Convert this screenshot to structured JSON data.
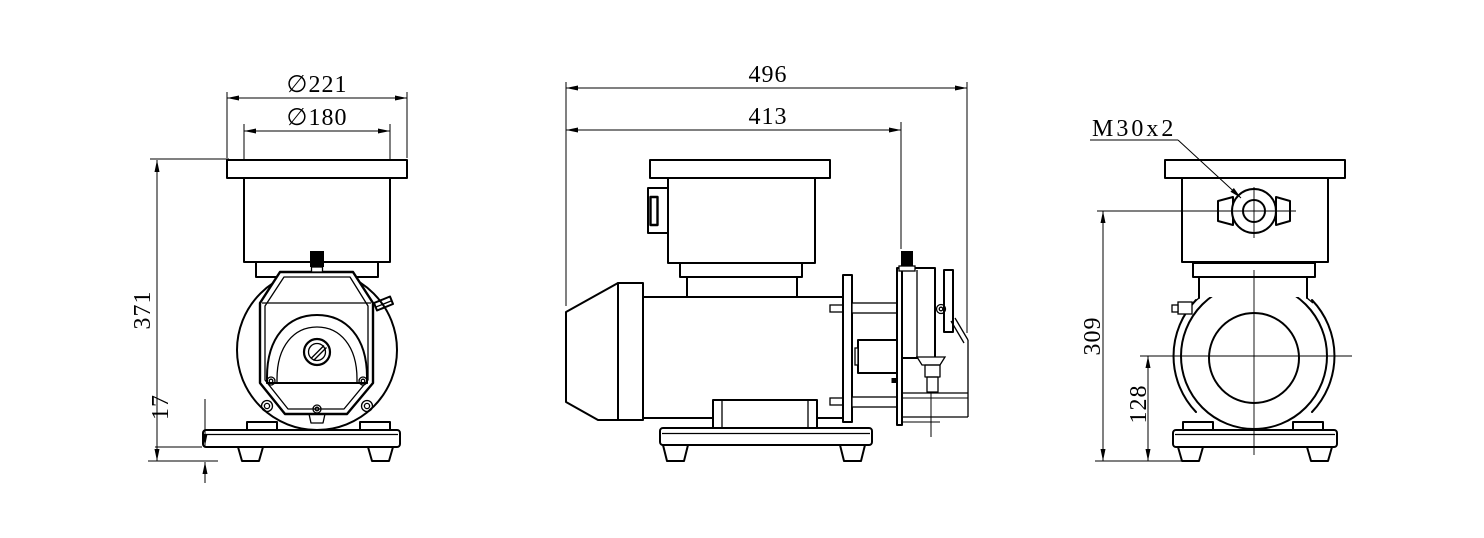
{
  "drawing": {
    "background": "#ffffff",
    "line_color": "#000000",
    "views": {
      "front": {
        "dims": {
          "flange_diameter": "∅221",
          "housing_diameter": "∅180",
          "overall_height": "371",
          "foot_height": "17"
        }
      },
      "side": {
        "dims": {
          "overall_length": "496",
          "length_to_head_face": "413"
        }
      },
      "rear": {
        "dims": {
          "inlet_thread": "M30x2",
          "inlet_center_height": "309",
          "shaft_center_height": "128"
        }
      }
    }
  }
}
